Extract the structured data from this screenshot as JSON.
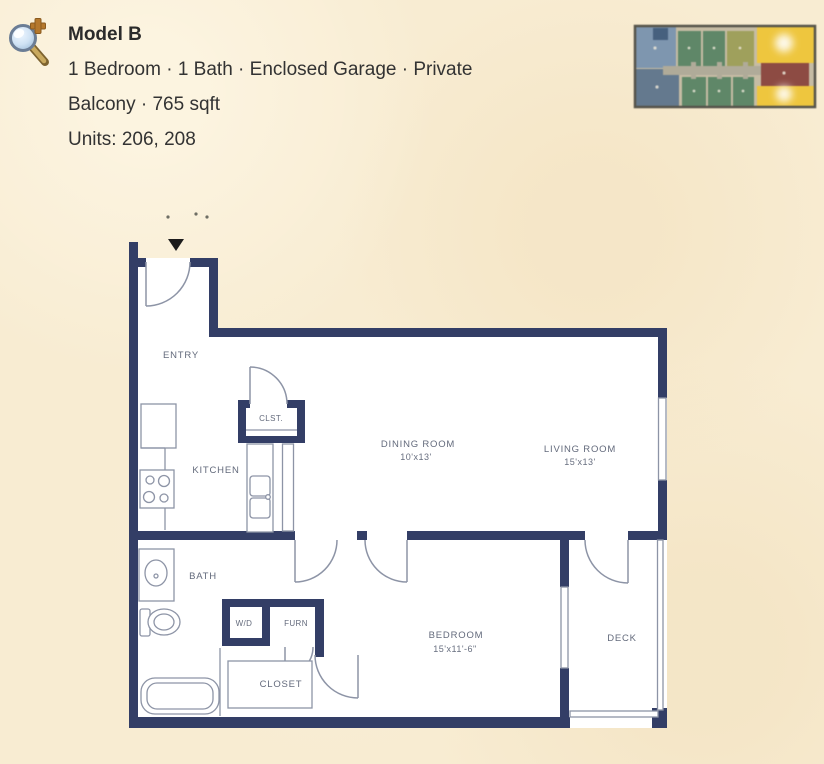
{
  "page": {
    "background_color": "#f8ecd2"
  },
  "header": {
    "zoom_icon": "magnifier-plus",
    "title": "Model B",
    "description_line1": "1 Bedroom · 1 Bath · Enclosed Garage · Private",
    "description_line2": "Balcony · 765 sqft",
    "units_line": "Units: 206, 208"
  },
  "thumbnail": {
    "meaning": "building-floorplate-overview-with-model-b-units-highlighted",
    "colors": {
      "outline": "#56544a",
      "base": "#c6bca4",
      "corridor": "#b0ab99",
      "unit_blue_light": "#7e96af",
      "unit_blue_deep": "#46607e",
      "unit_blue_dark": "#64798e",
      "unit_green": "#5f8768",
      "unit_olive": "#9fa05c",
      "unit_maroon": "#8d4b43",
      "unit_highlight": "#eec63e"
    }
  },
  "floorplan": {
    "wall_color": "#333e66",
    "line_color": "#8d94a6",
    "label_color": "#4d5569",
    "arrow_color": "#1c1c1c",
    "labels": {
      "entry": "ENTRY",
      "clst": "CLST.",
      "kitchen": "KITCHEN",
      "dining_name": "DINING ROOM",
      "dining_dims": "10'x13'",
      "living_name": "LIVING ROOM",
      "living_dims": "15'x13'",
      "bath": "BATH",
      "wd": "W/D",
      "furn": "FURN",
      "closet": "CLOSET",
      "bedroom_name": "BEDROOM",
      "bedroom_dims": "15'x11'-6\"",
      "deck": "DECK"
    }
  }
}
